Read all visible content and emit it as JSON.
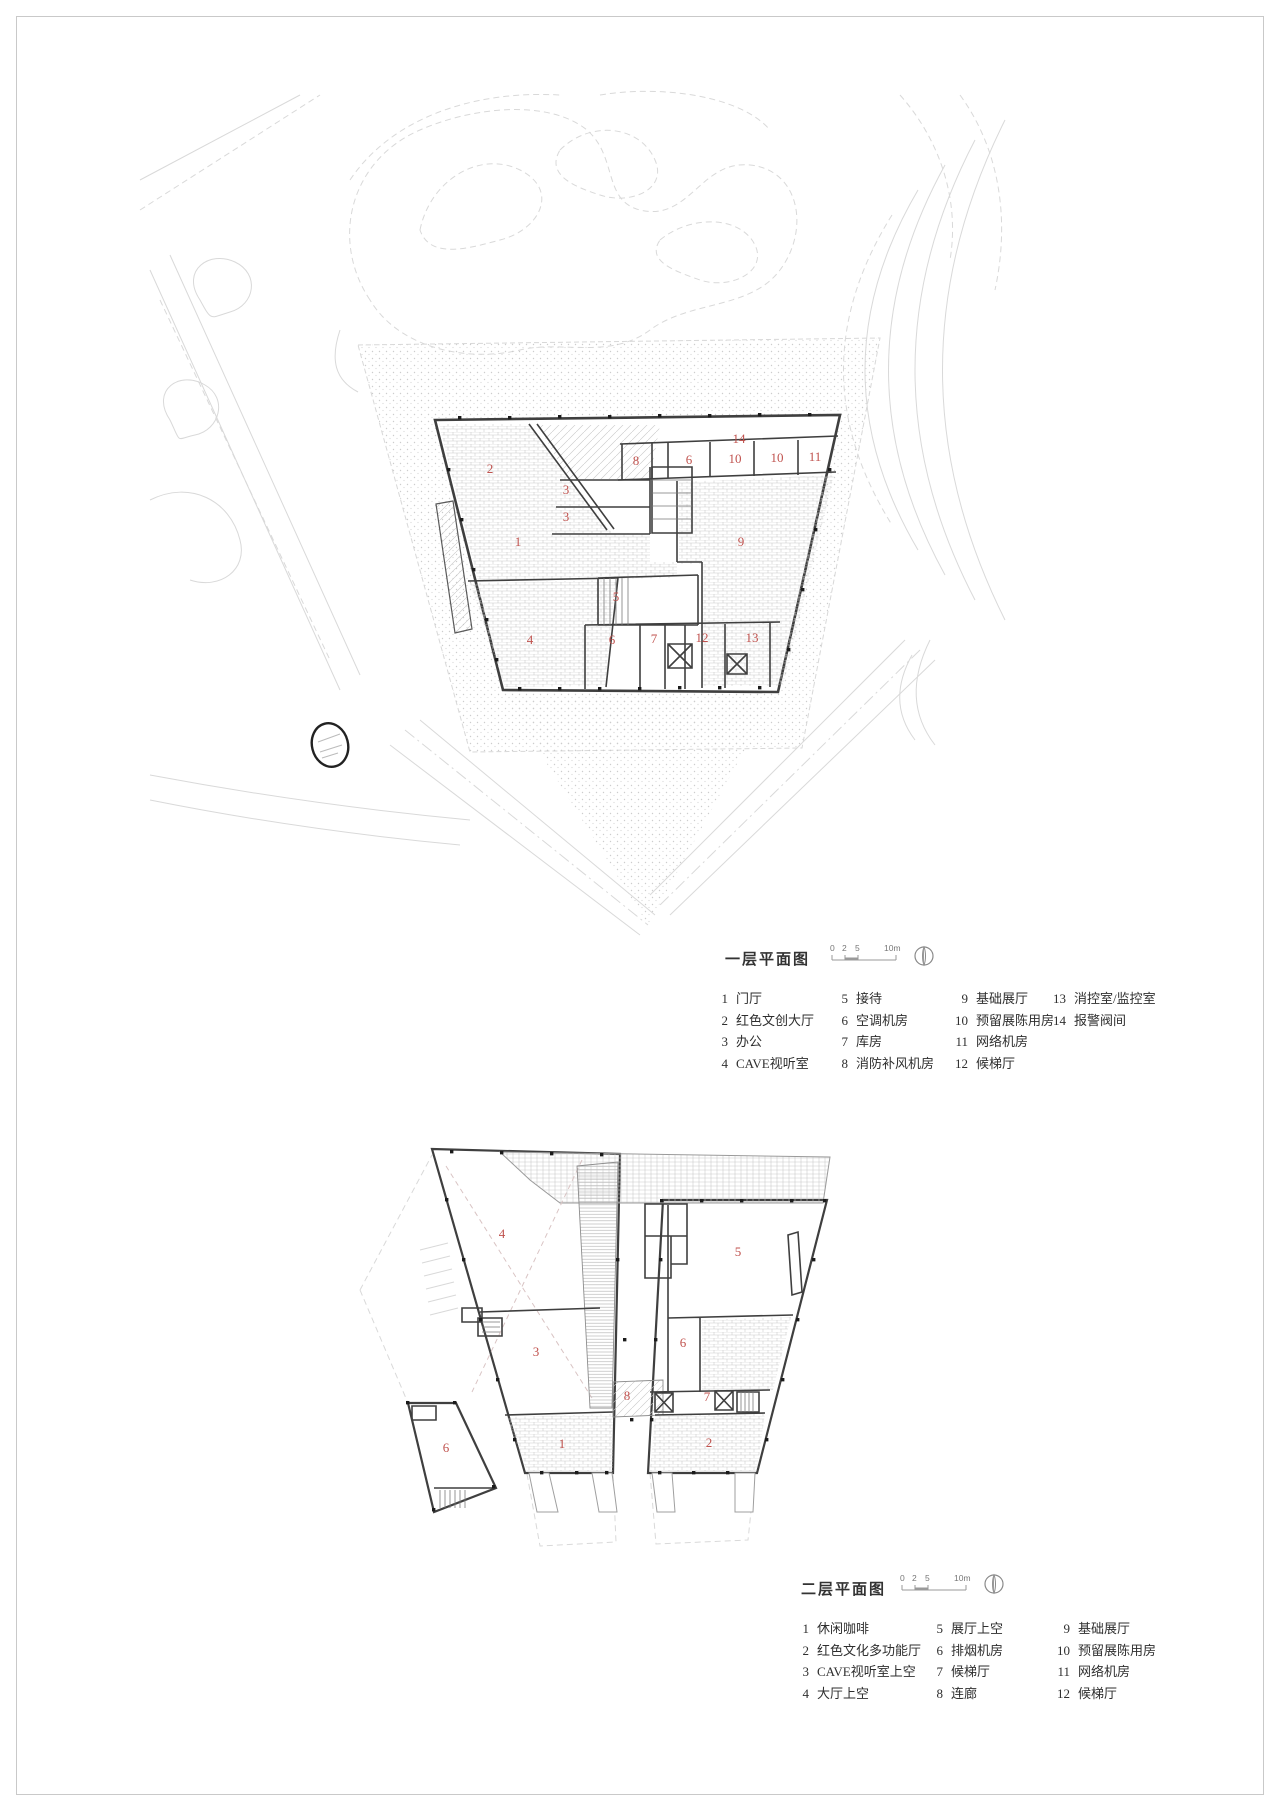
{
  "page": {
    "background": "#ffffff",
    "frame_color": "#c9c9c9"
  },
  "colors": {
    "room_number_red": "#c0524e",
    "wall_line": "#3f3f3f",
    "hatch_gray": "#c9c9c9",
    "site_gray": "#d9d9d9"
  },
  "plan1": {
    "title": "一层平面图",
    "scale": {
      "labels": [
        "0",
        "2",
        "5",
        "10m"
      ]
    },
    "north_icon": "north-arrow",
    "legend": {
      "c1": [
        {
          "n": "1",
          "label": "门厅"
        },
        {
          "n": "2",
          "label": "红色文创大厅"
        },
        {
          "n": "3",
          "label": "办公"
        },
        {
          "n": "4",
          "label": "CAVE视听室"
        }
      ],
      "c2": [
        {
          "n": "5",
          "label": "接待"
        },
        {
          "n": "6",
          "label": "空调机房"
        },
        {
          "n": "7",
          "label": "库房"
        },
        {
          "n": "8",
          "label": "消防补风机房"
        }
      ],
      "c3": [
        {
          "n": "9",
          "label": "基础展厅"
        },
        {
          "n": "10",
          "label": "预留展陈用房"
        },
        {
          "n": "11",
          "label": "网络机房"
        },
        {
          "n": "12",
          "label": "候梯厅"
        }
      ],
      "c4": [
        {
          "n": "13",
          "label": "消控室/监控室"
        },
        {
          "n": "14",
          "label": "报警阀间"
        }
      ]
    },
    "rooms": [
      {
        "n": "2"
      },
      {
        "n": "3"
      },
      {
        "n": "3"
      },
      {
        "n": "1"
      },
      {
        "n": "8"
      },
      {
        "n": "6"
      },
      {
        "n": "10"
      },
      {
        "n": "10"
      },
      {
        "n": "11"
      },
      {
        "n": "14"
      },
      {
        "n": "9"
      },
      {
        "n": "5"
      },
      {
        "n": "4"
      },
      {
        "n": "6"
      },
      {
        "n": "7"
      },
      {
        "n": "12"
      },
      {
        "n": "13"
      }
    ]
  },
  "plan2": {
    "title": "二层平面图",
    "scale": {
      "labels": [
        "0",
        "2",
        "5",
        "10m"
      ]
    },
    "north_icon": "north-arrow",
    "legend": {
      "c1": [
        {
          "n": "1",
          "label": "休闲咖啡"
        },
        {
          "n": "2",
          "label": "红色文化多功能厅"
        },
        {
          "n": "3",
          "label": "CAVE视听室上空"
        },
        {
          "n": "4",
          "label": "大厅上空"
        }
      ],
      "c2": [
        {
          "n": "5",
          "label": "展厅上空"
        },
        {
          "n": "6",
          "label": "排烟机房"
        },
        {
          "n": "7",
          "label": "候梯厅"
        },
        {
          "n": "8",
          "label": "连廊"
        }
      ],
      "c3": [
        {
          "n": "9",
          "label": "基础展厅"
        },
        {
          "n": "10",
          "label": "预留展陈用房"
        },
        {
          "n": "11",
          "label": "网络机房"
        },
        {
          "n": "12",
          "label": "候梯厅"
        }
      ]
    },
    "rooms": [
      {
        "n": "4"
      },
      {
        "n": "5"
      },
      {
        "n": "3"
      },
      {
        "n": "6"
      },
      {
        "n": "8"
      },
      {
        "n": "7"
      },
      {
        "n": "1"
      },
      {
        "n": "2"
      },
      {
        "n": "6"
      }
    ]
  }
}
